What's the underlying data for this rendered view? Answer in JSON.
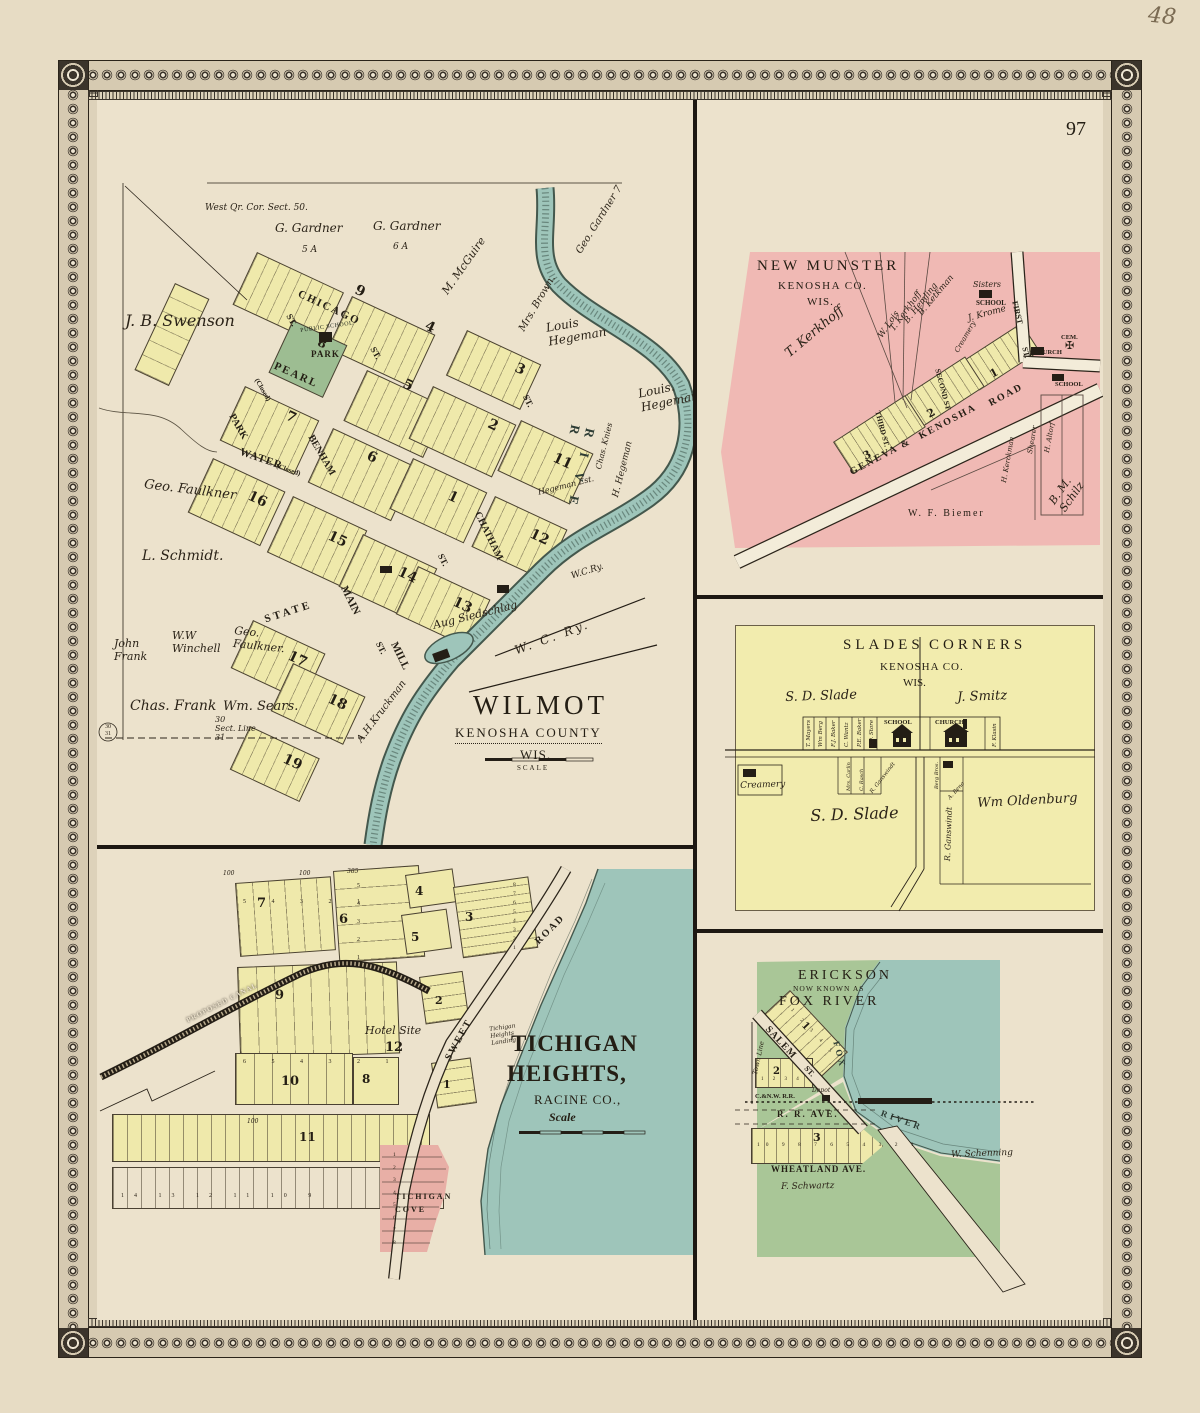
{
  "page": {
    "number": "97",
    "handwritten_note": "48"
  },
  "wilmot": {
    "title": "WILMOT",
    "county": "KENOSHA COUNTY",
    "state": "WIS.",
    "scale_label": "SCALE",
    "corner_note": "West Qr. Cor. Sect. 50.",
    "section_line": "30\nSect. Line\n31",
    "stamp": "30\n31",
    "park": {
      "line1": "PUBLIC SCHOOL",
      "number": "8",
      "line2": "PARK"
    },
    "river": "R I V E R",
    "rail1": "W.C.Ry.",
    "rail2": "W. C. Ry.",
    "owners": [
      "J. B. Swenson",
      "G. Gardner",
      "5 A",
      "G. Gardner",
      "6 A",
      "M. McGuire",
      "Mrs. Brown.",
      "Geo. Gardner 7",
      "Louis\nHegeman",
      "Louis.\nHegeman",
      "Geo. Faulkner",
      "L. Schmidt.",
      "John\nFrank",
      "W.W\nWinchell",
      "Geo.\nFaulkner.",
      "Chas. Frank",
      "Wm. Sears.",
      "A.H.Kruckman",
      "Aug Siedschlag",
      "Chas. Knies",
      "Hegeman Est.",
      "H. Hegeman"
    ],
    "streets": [
      "CHICAGO",
      "PEARL",
      "PARK",
      "(Closed)",
      "WATER",
      "(Closed)",
      "BENHAM",
      "STATE",
      "MAIN",
      "MILL",
      "CHATHAM",
      "ST.",
      "ST.",
      "ST.",
      "ST.",
      "ST."
    ],
    "blocks": [
      "9",
      "4",
      "5",
      "7",
      "6",
      "2",
      "3",
      "1",
      "11",
      "12",
      "13",
      "14",
      "15",
      "16",
      "17",
      "18",
      "19"
    ]
  },
  "new_munster": {
    "title": "NEW MUNSTER",
    "county": "KENOSHA CO.",
    "state": "WIS.",
    "owners": [
      "T. Kerkhoff",
      "B. Ketkman",
      "B. Hemling",
      "T. Kerkhoff",
      "W. Lois",
      "J. Krome",
      "W. F. Biemer",
      "B. M. Schilz",
      "Shearer",
      "H. Altorf",
      "H. Kerckman"
    ],
    "places": [
      "Sisters",
      "SCHOOL",
      "CEM.",
      "CHURCH",
      "SCHOOL",
      "Creamery"
    ],
    "cross": "✠",
    "streets": [
      "FIRST",
      "ST.",
      "SECOND ST",
      "THIRD ST.",
      "GENEVA &",
      "KENOSHA",
      "ROAD"
    ],
    "blocks": [
      "1",
      "2",
      "3"
    ]
  },
  "slades_corners": {
    "title1": "SLADES",
    "title2": "CORNERS",
    "county": "KENOSHA CO.",
    "state": "WIS.",
    "owners": [
      "S. D. Slade",
      "J. Smitz",
      "S. D. Slade",
      "Wm Oldenburg",
      "R. Ganswindt"
    ],
    "lots": [
      "T. Mayers",
      "Wm Berg",
      "F.J. Baker",
      "C. Wantz",
      "P.E. Baker",
      "P.O. Store",
      "F. Klasin",
      "Mrs. Carlin",
      "C. Rasch",
      "R. Ganswindt",
      "Berg Bros.",
      "A. Beno"
    ],
    "places": [
      "SCHOOL",
      "CHURCH",
      "Creamery"
    ]
  },
  "tichigan_heights": {
    "title": "TICHIGAN",
    "title2": "HEIGHTS,",
    "county": "RACINE CO.,",
    "scale_label": "Scale",
    "roads": [
      "SWEET",
      "ROAD",
      "PROPOSED CANAL"
    ],
    "landing": "Tichigan\nHeights\nLanding",
    "cove": "TICHIGAN\nCOVE",
    "hotel": "Hotel Site",
    "hotel_block": "12",
    "blocks": [
      "7",
      "6",
      "4",
      "5",
      "3",
      "9",
      "10",
      "8",
      "11",
      "2",
      "1"
    ],
    "lots": {
      "b7": "5    4    3    2    1",
      "b6": "5\n4\n3\n2\n1",
      "b3": "8\n7\n6\n5\n4\n3\n2\n1",
      "b10": "6    5    4    3    2    1",
      "cove": "1\n2\n3\n4\n5\n6\n7\n8",
      "strip": "14   13   12   11   10   9"
    },
    "dims": [
      "100",
      "100",
      "100",
      "385"
    ]
  },
  "erickson": {
    "title": "ERICKSON",
    "subtitle": "NOW KNOWN AS",
    "title2": "FOX RIVER",
    "streets": [
      "SALEM",
      "ST.",
      "Town Line",
      "R.  R.  AVE.",
      "WHEATLAND  AVE.",
      "C.&N.W. R.R."
    ],
    "river1": "FOX",
    "river2": "RIVER",
    "owners": [
      "W. Schenning",
      "F. Schwartz"
    ],
    "depot": "Depot",
    "blocks": [
      "1",
      "2",
      "3"
    ],
    "lots": {
      "b1": "1  2  3  4  5",
      "b2": "1  2  3  4",
      "b3": "10   9   8   7   6   5   4   3   2   1"
    }
  }
}
